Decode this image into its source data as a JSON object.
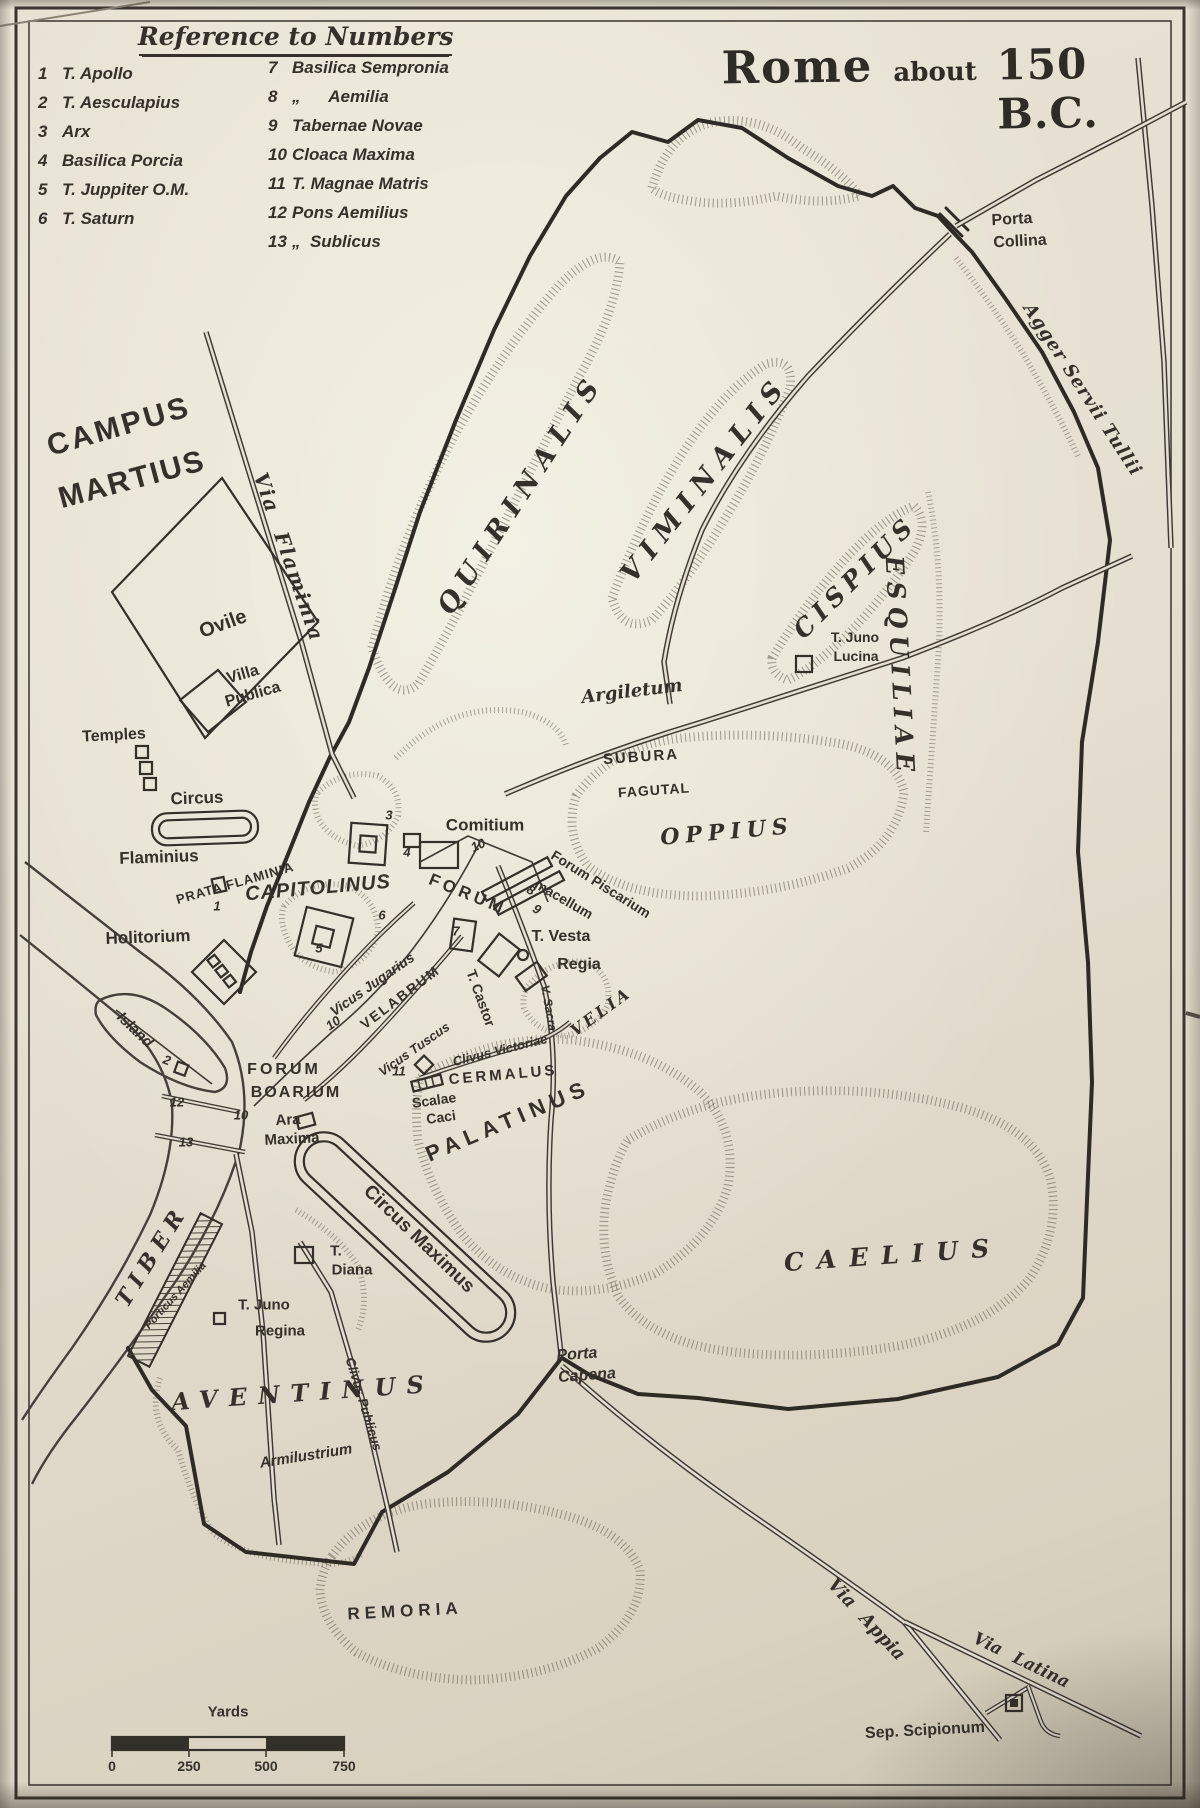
{
  "map": {
    "title": {
      "word1": "Rome",
      "word2": "about",
      "word3": "150 B.C."
    },
    "legend": {
      "heading": "Reference to Numbers",
      "col1": [
        {
          "n": "1",
          "t": "T. Apollo"
        },
        {
          "n": "2",
          "t": "T. Aesculapius"
        },
        {
          "n": "3",
          "t": "Arx"
        },
        {
          "n": "4",
          "t": "Basilica Porcia"
        },
        {
          "n": "5",
          "t": "T. Juppiter O.M."
        },
        {
          "n": "6",
          "t": "T. Saturn"
        }
      ],
      "col2": [
        {
          "n": "7",
          "t": "Basilica Sempronia"
        },
        {
          "n": "8",
          "t": "„      Aemilia"
        },
        {
          "n": "9",
          "t": "Tabernae Novae"
        },
        {
          "n": "10",
          "t": "Cloaca Maxima"
        },
        {
          "n": "11",
          "t": "T. Magnae Matris"
        },
        {
          "n": "12",
          "t": "Pons Aemilius"
        },
        {
          "n": "13",
          "t": "„  Sublicus"
        }
      ]
    },
    "scale": {
      "unit": "Yards",
      "ticks": [
        {
          "t": "0",
          "x": 112
        },
        {
          "t": "250",
          "x": 189
        },
        {
          "t": "500",
          "x": 266
        },
        {
          "t": "750",
          "x": 344
        }
      ]
    },
    "colors": {
      "paper": "#e4dfd1",
      "ink": "#35312a"
    },
    "labels": [
      {
        "id": "campus-martius-line1",
        "t": "CAMPUS",
        "x": 119,
        "y": 427,
        "r": -16,
        "c": "caps",
        "fs": 30,
        "ls": 3
      },
      {
        "id": "campus-martius-line2",
        "t": "MARTIUS",
        "x": 132,
        "y": 480,
        "r": -15,
        "c": "caps",
        "fs": 30,
        "ls": 2
      },
      {
        "id": "via-flaminia",
        "t": "Via Flaminia",
        "x": 289,
        "y": 557,
        "r": 71,
        "c": "road",
        "fs": 20,
        "ls": 2,
        "ws": 12
      },
      {
        "id": "ovile",
        "t": "Ovile",
        "x": 223,
        "y": 624,
        "r": -20,
        "c": "hand",
        "fs": 20
      },
      {
        "id": "villa-publica-line1",
        "t": "Villa",
        "x": 243,
        "y": 675,
        "r": -16,
        "c": "hand",
        "fs": 16
      },
      {
        "id": "villa-publica-line2",
        "t": "Publica",
        "x": 253,
        "y": 695,
        "r": -16,
        "c": "hand",
        "fs": 16
      },
      {
        "id": "temples",
        "t": "Temples",
        "x": 114,
        "y": 736,
        "r": -3,
        "c": "hand",
        "fs": 16
      },
      {
        "id": "circus-flaminius-line1",
        "t": "Circus",
        "x": 197,
        "y": 798,
        "r": -2,
        "c": "hand",
        "fs": 17
      },
      {
        "id": "circus-flaminius-line2",
        "t": "Flaminius",
        "x": 159,
        "y": 857,
        "r": -2,
        "c": "hand",
        "fs": 17
      },
      {
        "id": "prata-flaminia",
        "t": "PRATA FLAMINIA",
        "x": 235,
        "y": 883,
        "r": -16,
        "c": "caps",
        "fs": 13,
        "ls": 1
      },
      {
        "id": "capitolinus",
        "t": "CAPITOLINUS",
        "x": 318,
        "y": 888,
        "r": -5,
        "c": "capsi",
        "fs": 20,
        "ls": 1
      },
      {
        "id": "holitorium",
        "t": "Holitorium",
        "x": 148,
        "y": 937,
        "r": -2,
        "c": "hand",
        "fs": 17
      },
      {
        "id": "island",
        "t": "Island",
        "x": 135,
        "y": 1030,
        "r": 44,
        "c": "handi",
        "fs": 15
      },
      {
        "id": "forum-boarium-line1",
        "t": "FORUM",
        "x": 284,
        "y": 1070,
        "r": 0,
        "c": "caps",
        "fs": 16,
        "ls": 3
      },
      {
        "id": "forum-boarium-line2",
        "t": "BOARIUM",
        "x": 296,
        "y": 1093,
        "r": 0,
        "c": "caps",
        "fs": 16,
        "ls": 2
      },
      {
        "id": "ara-maxima-line1",
        "t": "Ara",
        "x": 288,
        "y": 1120,
        "r": -3,
        "c": "hand",
        "fs": 15
      },
      {
        "id": "ara-maxima-line2",
        "t": "Maxima",
        "x": 292,
        "y": 1139,
        "r": -3,
        "c": "hand",
        "fs": 15
      },
      {
        "id": "tiber",
        "t": "TIBER",
        "x": 152,
        "y": 1256,
        "r": -58,
        "c": "hill",
        "fs": 22,
        "ls": 7
      },
      {
        "id": "porticus-aemilia",
        "t": "Porticus Aemilia",
        "x": 176,
        "y": 1296,
        "r": -48,
        "c": "handi",
        "fs": 11
      },
      {
        "id": "vicus-jugarius",
        "t": "Vicus Jugarius",
        "x": 372,
        "y": 984,
        "r": -35,
        "c": "handi",
        "fs": 14
      },
      {
        "id": "velabrum",
        "t": "VELABRUM",
        "x": 400,
        "y": 997,
        "r": -37,
        "c": "caps",
        "fs": 14,
        "ls": 2
      },
      {
        "id": "vicus-tuscus",
        "t": "Vicus Tuscus",
        "x": 414,
        "y": 1049,
        "r": -35,
        "c": "handi",
        "fs": 13
      },
      {
        "id": "forum",
        "t": "FORUM",
        "x": 468,
        "y": 894,
        "r": 22,
        "c": "caps",
        "fs": 17,
        "ls": 4
      },
      {
        "id": "comitium",
        "t": "Comitium",
        "x": 485,
        "y": 825,
        "r": 0,
        "c": "hand",
        "fs": 17
      },
      {
        "id": "forum-piscarium",
        "t": "Forum Piscarium",
        "x": 601,
        "y": 884,
        "r": 32,
        "c": "hand",
        "fs": 14
      },
      {
        "id": "macellum",
        "t": "macellum",
        "x": 564,
        "y": 899,
        "r": 30,
        "c": "hand",
        "fs": 14
      },
      {
        "id": "vesta",
        "t": "T. Vesta",
        "x": 561,
        "y": 937,
        "r": 0,
        "c": "hand",
        "fs": 16
      },
      {
        "id": "regia",
        "t": "Regia",
        "x": 579,
        "y": 965,
        "r": 0,
        "c": "hand",
        "fs": 16
      },
      {
        "id": "via-sacra",
        "t": "V. Sacra",
        "x": 549,
        "y": 1008,
        "r": 80,
        "c": "handi",
        "fs": 12
      },
      {
        "id": "castor",
        "t": "T. Castor",
        "x": 481,
        "y": 998,
        "r": 70,
        "c": "hand",
        "fs": 14
      },
      {
        "id": "velia",
        "t": "VELIA",
        "x": 601,
        "y": 1012,
        "r": -36,
        "c": "hill",
        "fs": 16,
        "ls": 3
      },
      {
        "id": "clivus-victoriae",
        "t": "Clivus Victoriae",
        "x": 500,
        "y": 1050,
        "r": -14,
        "c": "handi",
        "fs": 13
      },
      {
        "id": "cermalus",
        "t": "CERMALUS",
        "x": 503,
        "y": 1075,
        "r": -5,
        "c": "caps",
        "fs": 15,
        "ls": 3
      },
      {
        "id": "scalae-caci-line1",
        "t": "Scalae",
        "x": 434,
        "y": 1100,
        "r": -8,
        "c": "hand",
        "fs": 14
      },
      {
        "id": "scalae-caci-line2",
        "t": "Caci",
        "x": 441,
        "y": 1117,
        "r": -8,
        "c": "hand",
        "fs": 14
      },
      {
        "id": "palatinus",
        "t": "PALATINUS",
        "x": 508,
        "y": 1121,
        "r": -23,
        "c": "caps",
        "fs": 22,
        "ls": 6
      },
      {
        "id": "circus-maximus",
        "t": "Circus Maximus",
        "x": 419,
        "y": 1239,
        "r": 44,
        "c": "hand",
        "fs": 19
      },
      {
        "id": "subura",
        "t": "SUBURA",
        "x": 641,
        "y": 757,
        "r": -4,
        "c": "caps",
        "fs": 15,
        "ls": 2
      },
      {
        "id": "fagutal",
        "t": "FAGUTAL",
        "x": 654,
        "y": 790,
        "r": -4,
        "c": "caps",
        "fs": 14,
        "ls": 1
      },
      {
        "id": "oppius",
        "t": "OPPIUS",
        "x": 727,
        "y": 832,
        "r": -5,
        "c": "hill",
        "fs": 22,
        "ls": 6
      },
      {
        "id": "argiletum",
        "t": "Argiletum",
        "x": 632,
        "y": 692,
        "r": -7,
        "c": "road",
        "fs": 18
      },
      {
        "id": "quirinalis",
        "t": "QUIRINALIS",
        "x": 521,
        "y": 494,
        "r": -57,
        "c": "hill",
        "fs": 27,
        "ls": 9
      },
      {
        "id": "viminalis",
        "t": "VIMINALIS",
        "x": 705,
        "y": 479,
        "r": -52,
        "c": "hill",
        "fs": 27,
        "ls": 9
      },
      {
        "id": "cispius",
        "t": "CISPIUS",
        "x": 855,
        "y": 577,
        "r": -45,
        "c": "hill",
        "fs": 25,
        "ls": 6
      },
      {
        "id": "esquiliae",
        "t": "ESQUILIAE",
        "x": 900,
        "y": 667,
        "r": 87,
        "c": "hill",
        "fs": 25,
        "ls": 7
      },
      {
        "id": "t-juno-lucina-line1",
        "t": "T. Juno",
        "x": 855,
        "y": 637,
        "r": 0,
        "c": "hand",
        "fs": 14
      },
      {
        "id": "t-juno-lucina-line2",
        "t": "Lucina",
        "x": 856,
        "y": 656,
        "r": 0,
        "c": "hand",
        "fs": 14
      },
      {
        "id": "porta-collina-line1",
        "t": "Porta",
        "x": 1012,
        "y": 220,
        "r": -3,
        "c": "hand",
        "fs": 16
      },
      {
        "id": "porta-collina-line2",
        "t": "Collina",
        "x": 1020,
        "y": 242,
        "r": -3,
        "c": "hand",
        "fs": 16
      },
      {
        "id": "agger-servii-tullii",
        "t": "Agger Servii Tullii",
        "x": 1082,
        "y": 390,
        "r": 57,
        "c": "road",
        "fs": 18,
        "ls": 1
      },
      {
        "id": "caelius",
        "t": "CAELIUS",
        "x": 893,
        "y": 1255,
        "r": -4,
        "c": "hill",
        "fs": 25,
        "ls": 13
      },
      {
        "id": "porta-capena-line1",
        "t": "Porta",
        "x": 577,
        "y": 1355,
        "r": -4,
        "c": "handi",
        "fs": 16
      },
      {
        "id": "porta-capena-line2",
        "t": "Capena",
        "x": 587,
        "y": 1376,
        "r": -4,
        "c": "handi",
        "fs": 16
      },
      {
        "id": "aventinus",
        "t": "AVENTINUS",
        "x": 303,
        "y": 1393,
        "r": -4,
        "c": "hill",
        "fs": 24,
        "ls": 11
      },
      {
        "id": "armilustrium",
        "t": "Armilustrium",
        "x": 306,
        "y": 1456,
        "r": -9,
        "c": "handi",
        "fs": 15
      },
      {
        "id": "clivus-publicus",
        "t": "Clivus Publicus",
        "x": 364,
        "y": 1404,
        "r": 73,
        "c": "handi",
        "fs": 13
      },
      {
        "id": "t-diana-line1",
        "t": "T.",
        "x": 336,
        "y": 1251,
        "r": 0,
        "c": "hand",
        "fs": 15
      },
      {
        "id": "t-diana-line2",
        "t": "Diana",
        "x": 352,
        "y": 1270,
        "r": 0,
        "c": "hand",
        "fs": 15
      },
      {
        "id": "t-juno-regina-line1",
        "t": "T. Juno",
        "x": 264,
        "y": 1305,
        "r": 0,
        "c": "hand",
        "fs": 15
      },
      {
        "id": "t-juno-regina-line2",
        "t": "Regina",
        "x": 280,
        "y": 1331,
        "r": 0,
        "c": "hand",
        "fs": 15
      },
      {
        "id": "remoria",
        "t": "REMORIA",
        "x": 405,
        "y": 1611,
        "r": -3,
        "c": "caps",
        "fs": 17,
        "ls": 5
      },
      {
        "id": "via-appia",
        "t": "Via Appia",
        "x": 866,
        "y": 1620,
        "r": 47,
        "c": "road",
        "fs": 18,
        "ws": 8
      },
      {
        "id": "via-latina",
        "t": "Via Latina",
        "x": 1021,
        "y": 1661,
        "r": 26,
        "c": "road",
        "fs": 17,
        "ws": 8
      },
      {
        "id": "sep-scipionum",
        "t": "Sep. Scipionum",
        "x": 925,
        "y": 1731,
        "r": -3,
        "c": "hand",
        "fs": 16
      },
      {
        "id": "num-1",
        "t": "1",
        "x": 217,
        "y": 906,
        "r": 0,
        "c": "num",
        "fs": 13
      },
      {
        "id": "num-2",
        "t": "2",
        "x": 167,
        "y": 1060,
        "r": 20,
        "c": "num",
        "fs": 13
      },
      {
        "id": "num-3",
        "t": "3",
        "x": 389,
        "y": 815,
        "r": 0,
        "c": "num",
        "fs": 13
      },
      {
        "id": "num-4",
        "t": "4",
        "x": 407,
        "y": 852,
        "r": 0,
        "c": "num",
        "fs": 13
      },
      {
        "id": "num-5",
        "t": "5",
        "x": 319,
        "y": 948,
        "r": 0,
        "c": "num",
        "fs": 13
      },
      {
        "id": "num-6",
        "t": "6",
        "x": 382,
        "y": 915,
        "r": 0,
        "c": "num",
        "fs": 13
      },
      {
        "id": "num-7",
        "t": "7",
        "x": 456,
        "y": 931,
        "r": 0,
        "c": "num",
        "fs": 13
      },
      {
        "id": "num-8",
        "t": "8",
        "x": 531,
        "y": 890,
        "r": 30,
        "c": "num",
        "fs": 13
      },
      {
        "id": "num-9",
        "t": "9",
        "x": 537,
        "y": 909,
        "r": 30,
        "c": "num",
        "fs": 13
      },
      {
        "id": "num-10-forum",
        "t": "10",
        "x": 478,
        "y": 845,
        "r": -25,
        "c": "num",
        "fs": 13
      },
      {
        "id": "num-10-velabrum",
        "t": "10",
        "x": 333,
        "y": 1023,
        "r": -35,
        "c": "num",
        "fs": 13
      },
      {
        "id": "num-10-river",
        "t": "10",
        "x": 241,
        "y": 1115,
        "r": 0,
        "c": "num",
        "fs": 13
      },
      {
        "id": "num-11",
        "t": "11",
        "x": 399,
        "y": 1071,
        "r": 0,
        "c": "num",
        "fs": 13
      },
      {
        "id": "num-12",
        "t": "12",
        "x": 177,
        "y": 1102,
        "r": 0,
        "c": "num",
        "fs": 13
      },
      {
        "id": "num-13",
        "t": "13",
        "x": 186,
        "y": 1142,
        "r": 0,
        "c": "num",
        "fs": 13
      }
    ]
  }
}
